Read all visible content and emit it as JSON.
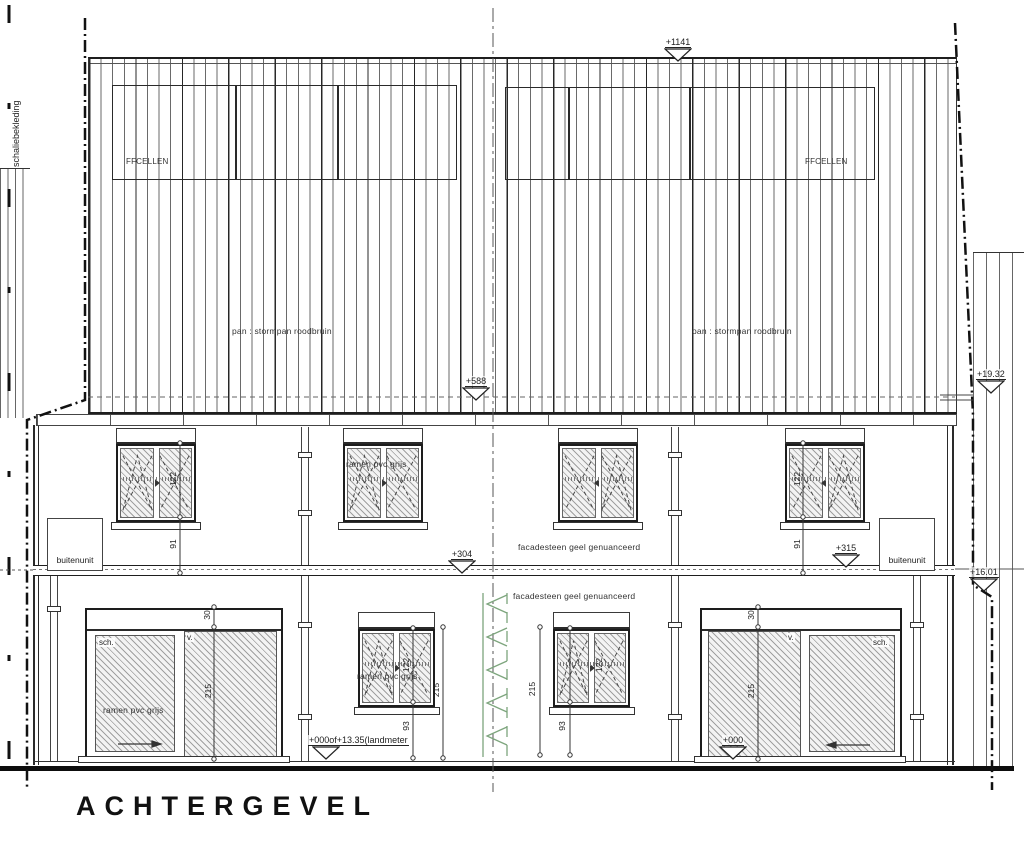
{
  "title": "ACHTERGEVEL",
  "roof": {
    "pv_label_left": "FFCELLEN",
    "pv_label_right": "FFCELLEN",
    "tile_label_left": "pan : stormpan roodbruin",
    "tile_label_right": "pan : stormpan roodbruin"
  },
  "facade": {
    "cladding_label": "schaliebekleding",
    "upper_label": "facadesteen geel genuanceerd",
    "lower_label": "facadesteen geel genuanceerd",
    "window_label_upper": "ramen pvc grijs",
    "window_label_lower": "ramen pvc grijs",
    "door_label": "ramen pvc grijs",
    "outdoor_unit_left": "buitenunit",
    "outdoor_unit_right": "buitenunit",
    "sliding_abbrev": "sch.",
    "fixed_abbrev": "v."
  },
  "markers": {
    "ridge": "+1141",
    "eaves": "+588",
    "floor_left": "+304",
    "floor_right": "+315",
    "neighbor_high": "+19.32",
    "neighbor_low": "+16.01",
    "door_zero": "+000",
    "ground_level": "+000of+13.35(landmeter"
  },
  "dimensions": {
    "window_height": "122",
    "upper_sill_height": "91",
    "lower_sill_height": "93",
    "roller_height": "30",
    "door_height": "215",
    "window_top_height": "215"
  },
  "colors": {
    "line": "#2b2b2b",
    "hatch_line": "#8a8a8a",
    "green": "#7da57d"
  }
}
